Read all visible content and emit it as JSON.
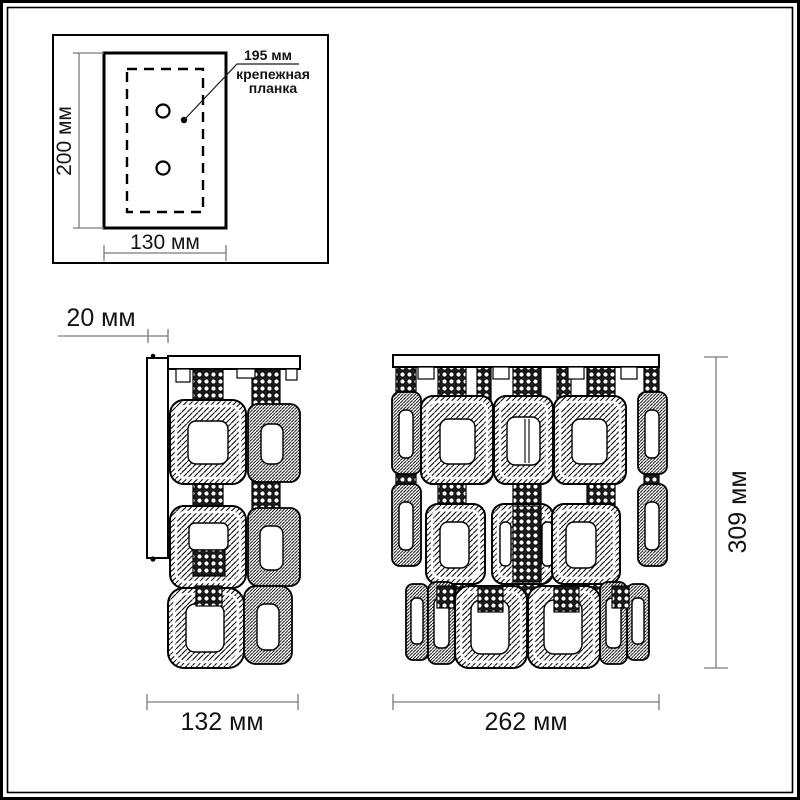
{
  "drawing": {
    "type": "wall-lamp dimensional drawing",
    "background": "#ffffff"
  },
  "inset": {
    "height_label": "200 мм",
    "width_label": "130 мм",
    "callout": {
      "value": "195 мм",
      "caption_line1": "крепежная",
      "caption_line2": "планка"
    }
  },
  "side_view": {
    "depth_label": "20 мм",
    "width_label": "132 мм"
  },
  "front_view": {
    "width_label": "262 мм",
    "height_label": "309 мм"
  },
  "colors": {
    "drawing_line": "#000000",
    "dimension_line": "#7a7a7a",
    "text": "#141414",
    "background": "#ffffff"
  }
}
